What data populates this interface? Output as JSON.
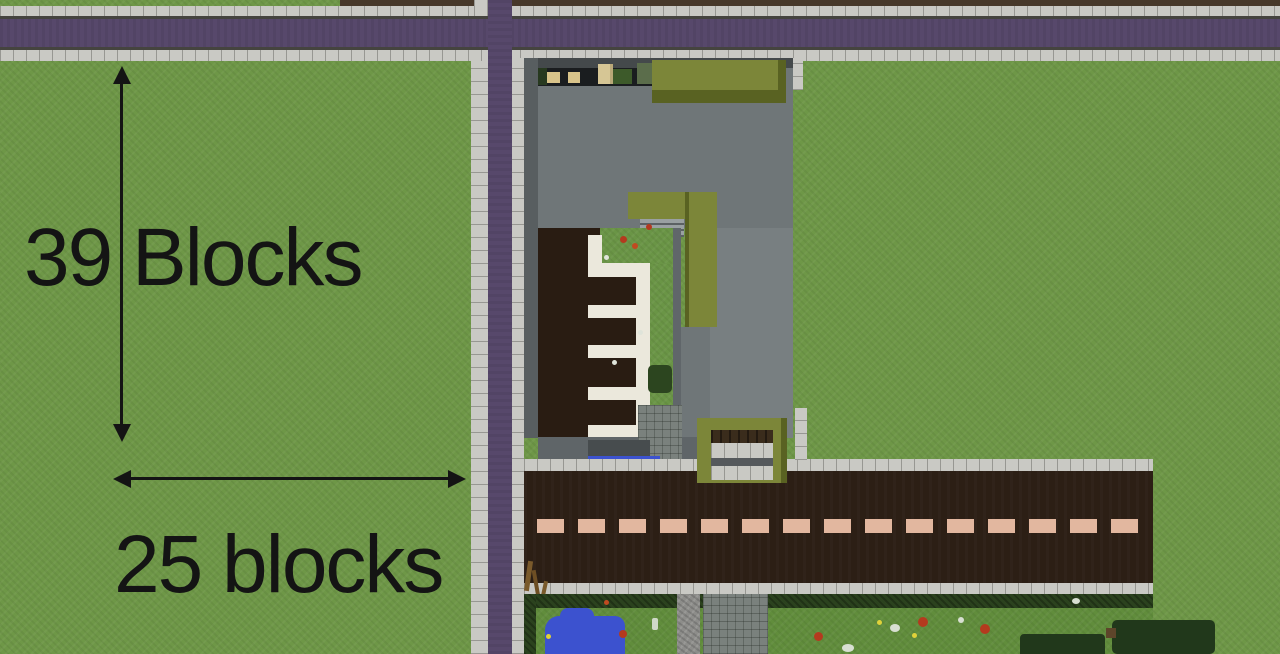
{
  "annotations": {
    "height_label": "39 Blocks",
    "width_label": "25 blocks"
  },
  "features": {
    "top_street": "purple street with stone sidewalks",
    "left_street": "vertical purple street with stone sidewalks",
    "building": "gray flat-roof building with olive canopies",
    "parking_area": "dark lot with white quartz parking dividers",
    "courtyard": "inner grass courtyard with flowers",
    "entrance": "olive framed entrance with steps",
    "bottom_road": "dark brown road with dashed center line",
    "garden": "hedged garden with pond, flowers and paths"
  },
  "colors": {
    "grass": "#6e9747",
    "garden_grass": "#618d3c",
    "dirt": "#47382a",
    "street_purple": "#57486b",
    "sidewalk": "#c9c9c4",
    "sidewalk_edge": "#45443f",
    "road_brown": "#2c1f15",
    "lane_dash": "#e2b79f",
    "roof_gray": "#6f7678",
    "roof_gray_light": "#787f81",
    "roof_edge_dark": "#44494b",
    "wall_gray": "#585e60",
    "canopy_olive": "#7c8639",
    "canopy_olive_dark": "#596222",
    "courtyard_floor": "#1a1d1f",
    "parking_brown": "#291c12",
    "quartz_white": "#ebe8dc",
    "stair_gray": "#9aa0a2",
    "stone_path": "#7a817d",
    "gravel": "#8d8d8a",
    "hedge": "#2b421e",
    "bush_dark": "#21381b",
    "pond_blue": "#3c52cf",
    "crate_birch": "#d9c48a",
    "annotation_text": "#141414"
  }
}
